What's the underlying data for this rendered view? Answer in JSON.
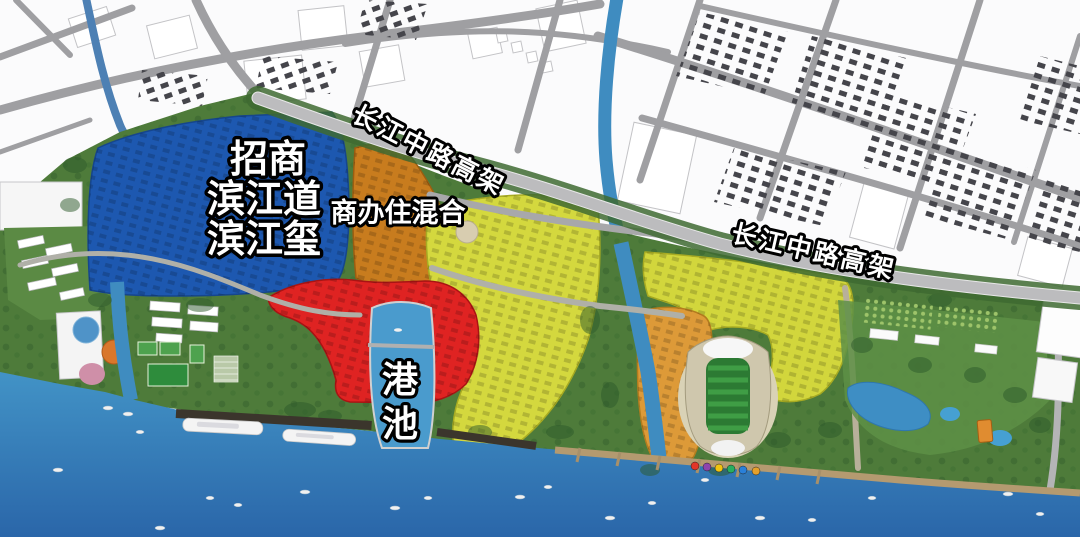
{
  "labels": {
    "blue_zone_lines": [
      "招商",
      "滨江道",
      "滨江玺"
    ],
    "mixed_zone": "商办住混合",
    "elevated_road_west": "长江中路高架",
    "elevated_road_east": "长江中路高架",
    "harbor_chars": [
      "港",
      "池"
    ]
  },
  "zones": {
    "blue_residential": {
      "color": "#1d58b0"
    },
    "mixed_use": {
      "color": "#c87c1e"
    },
    "red_core": {
      "color": "#df2322"
    },
    "yellow_central": {
      "color": "#d4d83e"
    },
    "yellow_east": {
      "color": "#d2d63c"
    },
    "orange_east": {
      "color": "#dd9a38"
    },
    "harbor_basin": {
      "color": "#4a9bcd"
    }
  },
  "colors": {
    "river_water": "#3f8cc0",
    "bay_water_top": "#4293c6",
    "bay_water_bottom": "#2a66a9",
    "park_green": "#4e7b3a",
    "highway": "#bcbcbe",
    "city_road": "#9f9fa2",
    "dark_building": "#45454b",
    "label_fill": "#ffffff",
    "label_outline": "#000000"
  }
}
